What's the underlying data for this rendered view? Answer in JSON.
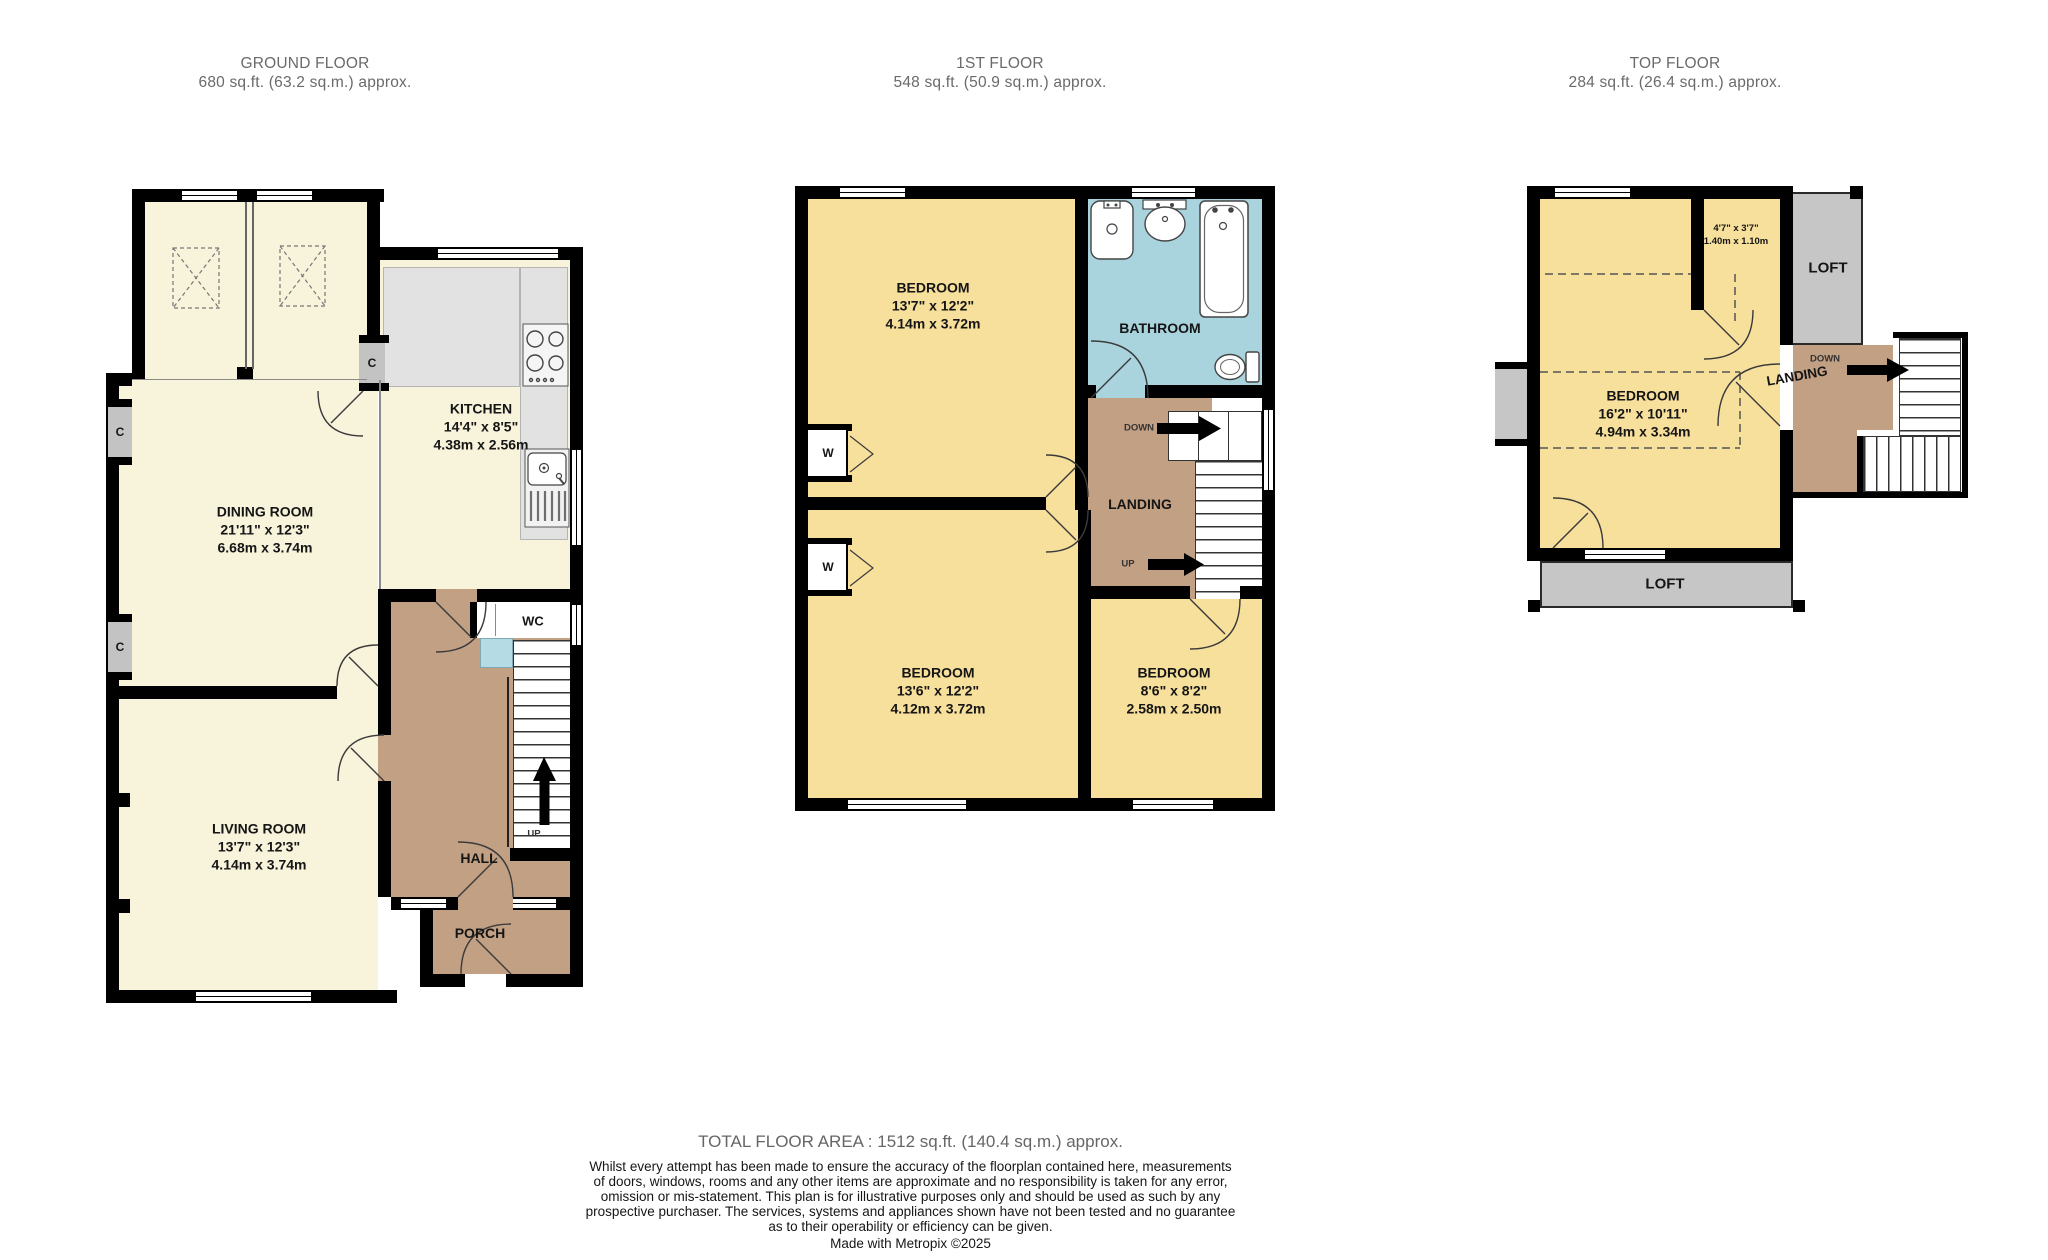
{
  "palette": {
    "wall": "#000000",
    "room_cream": "#F8F3DB",
    "room_yellow": "#F7DF9C",
    "hall_tan": "#C2A084",
    "bathroom_blue": "#A9D4DE",
    "loft_gray": "#C6C6C6",
    "counter_gray": "#E2E2E2",
    "heading_text": "#6A6A6A",
    "label_text": "#151515"
  },
  "floors": {
    "ground": {
      "title": "GROUND FLOOR",
      "area": "680 sq.ft. (63.2 sq.m.) approx.",
      "rooms": {
        "dining": {
          "name": "DINING ROOM",
          "size_imperial": "21'11\"  x 12'3\"",
          "size_metric": "6.68m  x 3.74m"
        },
        "kitchen": {
          "name": "KITCHEN",
          "size_imperial": "14'4\"  x 8'5\"",
          "size_metric": "4.38m  x 2.56m"
        },
        "living": {
          "name": "LIVING ROOM",
          "size_imperial": "13'7\"  x 12'3\"",
          "size_metric": "4.14m  x 3.74m"
        },
        "wc": {
          "name": "WC"
        },
        "hall": {
          "name": "HALL"
        },
        "porch": {
          "name": "PORCH"
        }
      },
      "labels": {
        "up": "UP",
        "closet": "C"
      }
    },
    "first": {
      "title": "1ST FLOOR",
      "area": "548 sq.ft. (50.9 sq.m.) approx.",
      "rooms": {
        "bedroom1": {
          "name": "BEDROOM",
          "size_imperial": "13'7\"  x 12'2\"",
          "size_metric": "4.14m  x 3.72m"
        },
        "bathroom": {
          "name": "BATHROOM"
        },
        "landing": {
          "name": "LANDING"
        },
        "bedroom2": {
          "name": "BEDROOM",
          "size_imperial": "13'6\"  x 12'2\"",
          "size_metric": "4.12m  x 3.72m"
        },
        "bedroom3": {
          "name": "BEDROOM",
          "size_imperial": "8'6\"  x 8'2\"",
          "size_metric": "2.58m  x 2.50m"
        }
      },
      "labels": {
        "up": "UP",
        "down": "DOWN",
        "wardrobe": "W"
      }
    },
    "top": {
      "title": "TOP FLOOR",
      "area": "284 sq.ft. (26.4 sq.m.) approx.",
      "rooms": {
        "bedroom": {
          "name": "BEDROOM",
          "size_imperial": "16'2\"  x 10'11\"",
          "size_metric": "4.94m  x 3.34m"
        },
        "store": {
          "size_imperial": "4'7\"  x 3'7\"",
          "size_metric": "1.40m  x 1.10m"
        },
        "landing": {
          "name": "LANDING"
        },
        "loft_upper": {
          "name": "LOFT"
        },
        "loft_lower": {
          "name": "LOFT"
        }
      },
      "labels": {
        "down": "DOWN"
      }
    }
  },
  "footer": {
    "total": "TOTAL FLOOR AREA : 1512 sq.ft. (140.4 sq.m.) approx.",
    "disclaimer": [
      "Whilst every attempt has been made to ensure the accuracy of the floorplan contained here, measurements",
      "of doors, windows, rooms and any other items are approximate and no responsibility is taken for any error,",
      "omission or mis-statement. This plan is for illustrative purposes only and should be used as such by any",
      "prospective purchaser. The services, systems and appliances shown have not been tested and no guarantee",
      "as to their operability or efficiency can be given."
    ],
    "credit": "Made with Metropix ©2025"
  }
}
